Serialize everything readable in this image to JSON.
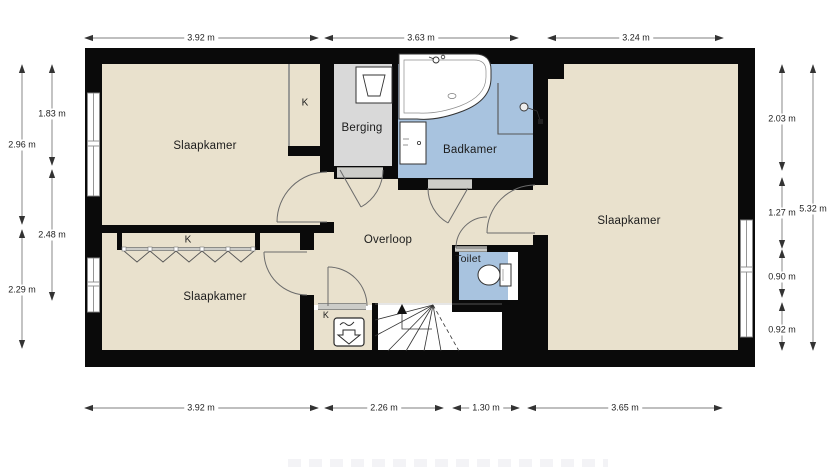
{
  "floorplan": {
    "rooms": {
      "bedroom_top_left": {
        "label": "Slaapkamer"
      },
      "bedroom_bottom_left": {
        "label": "Slaapkamer"
      },
      "bedroom_right": {
        "label": "Slaapkamer"
      },
      "storage": {
        "label": "Berging"
      },
      "bathroom": {
        "label": "Badkamer"
      },
      "landing": {
        "label": "Overloop"
      },
      "toilet": {
        "label": "Toilet"
      },
      "closet_top_left": {
        "label": "K"
      },
      "closet_bottom_left": {
        "label": "K"
      },
      "closet_mechanical": {
        "label": "K"
      }
    },
    "colors": {
      "floor": "#e9e1cd",
      "wet": "#a8c3df",
      "storage": "#d9d9d9",
      "wall": "#0a0a0a"
    },
    "icons": [
      "bathtub-icon",
      "shower-icon",
      "washbasin-icon",
      "toilet-icon",
      "washer-sink-icon",
      "mechanical-ventilation-icon",
      "stairs-up-icon",
      "window-icon",
      "door-arc-icon"
    ],
    "dimensions": {
      "top": [
        "3.92 m",
        "3.63 m",
        "3.24 m"
      ],
      "bottom": [
        "3.92 m",
        "2.26 m",
        "1.30 m",
        "3.65 m"
      ],
      "left_outer": [
        "2.96 m",
        "2.29 m"
      ],
      "left_inner": [
        "1.83 m",
        "2.48 m"
      ],
      "right_inner": [
        "2.03 m",
        "1.27 m",
        "0.90 m",
        "0.92 m"
      ],
      "right_outer": [
        "5.32 m"
      ]
    }
  }
}
